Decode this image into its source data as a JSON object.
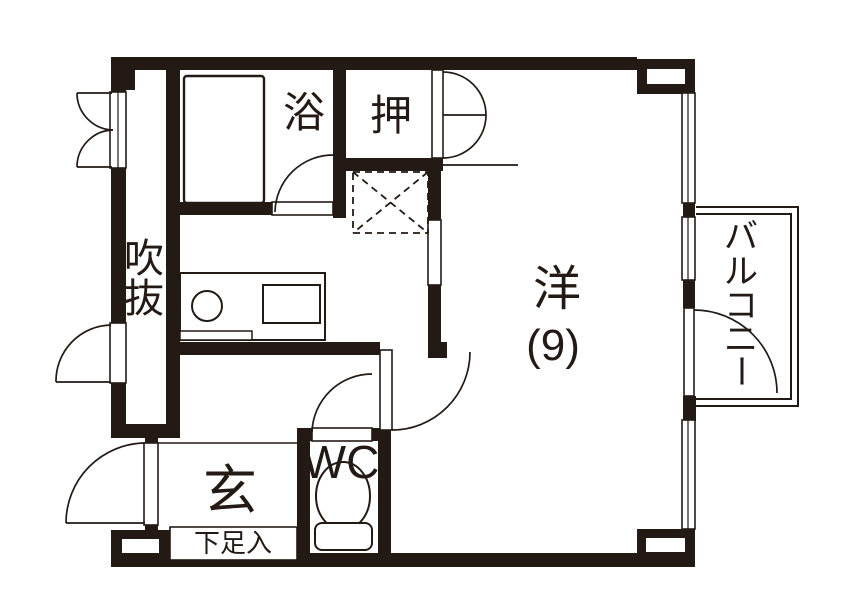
{
  "title": "apartment-floor-plan",
  "colors": {
    "wall": "#231a15",
    "bg": "#ffffff",
    "line": "#231a15"
  },
  "rooms": {
    "bath": {
      "label": "浴"
    },
    "closet": {
      "label": "押"
    },
    "western": {
      "label": "洋",
      "size": "(9)"
    },
    "void": {
      "label": "吹抜",
      "chars": [
        "吹",
        "抜"
      ]
    },
    "entrance": {
      "label": "玄"
    },
    "wc": {
      "label": "WC"
    },
    "shoebox": {
      "label": "下足入"
    },
    "balcony": {
      "label": "バルコニー",
      "chars": [
        "バ",
        "ル",
        "コ",
        "ニ",
        "ー"
      ]
    }
  },
  "fixtures": [
    "bathtub",
    "kitchen-sink",
    "kitchen-counter",
    "stove",
    "refrigerator-space",
    "toilet",
    "balcony-railing"
  ]
}
